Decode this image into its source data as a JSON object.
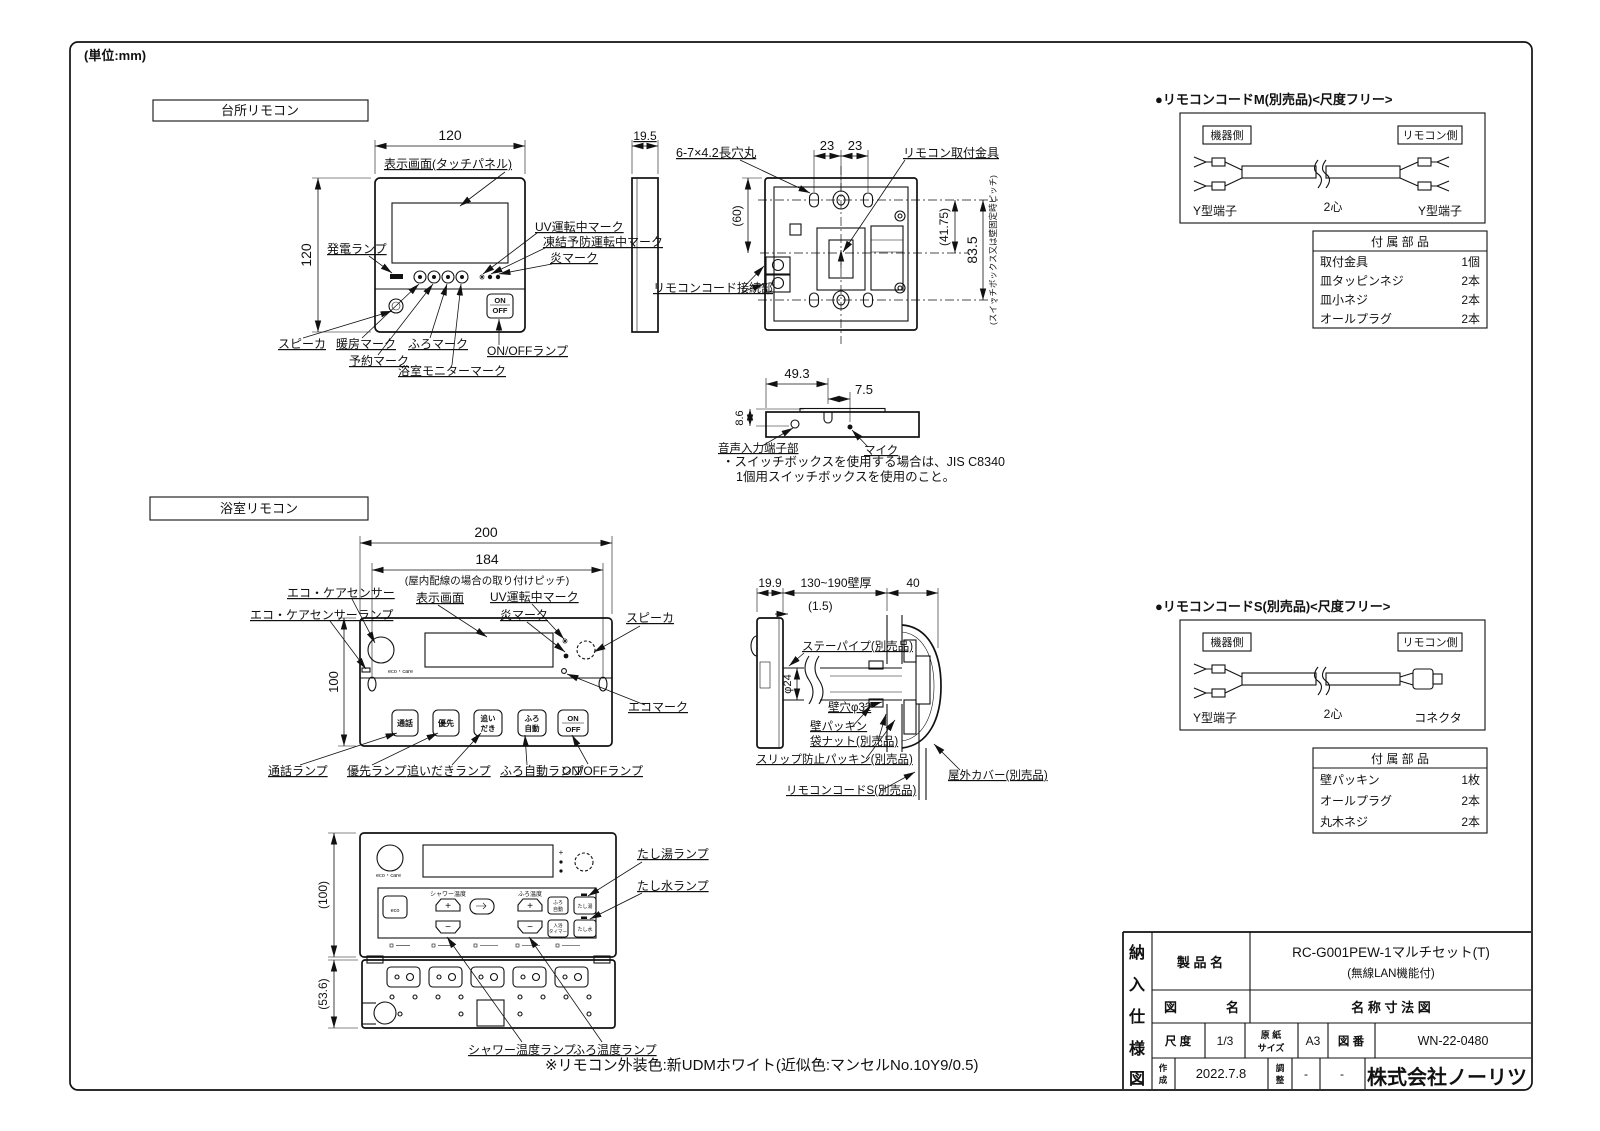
{
  "meta": {
    "units": "(単位:mm)",
    "footnote": "※リモコン外装色:新UDMホワイト(近似色:マンセルNo.10Y9/0.5)"
  },
  "kitchen": {
    "title": "台所リモコン",
    "dims": {
      "w": "120",
      "h": "120",
      "d": "19.5",
      "p23a": "23",
      "p23b": "23",
      "h60": "(60)",
      "h4175": "(41.75)",
      "h835": "83.5",
      "mic_w": "49.3",
      "mic_p": "7.5",
      "mic_h": "8.6"
    },
    "labels": {
      "display": "表示画面(タッチパネル)",
      "power": "発電ランプ",
      "speaker": "スピーカ",
      "heat": "暖房マーク",
      "reserve": "予約マーク",
      "furo": "ふろマーク",
      "monitor": "浴室モニターマーク",
      "uv": "UV運転中マーク",
      "freeze": "凍結予防運転中マーク",
      "flame": "炎マーク",
      "onoff": "ON/OFFランプ",
      "slot": "6-7×4.2長穴丸",
      "bracket": "リモコン取付金具",
      "pitch": "(スイッチボックス又は壁固定時ピッチ)",
      "cord": "リモコンコード接続部",
      "audio": "音声入力端子部",
      "mic": "マイク"
    },
    "btn": {
      "on": "ON",
      "off": "OFF"
    },
    "notes": [
      "・スイッチボックスを使用する場合は、JIS C8340",
      "1個用スイッチボックスを使用のこと。"
    ]
  },
  "bath": {
    "title": "浴室リモコン",
    "dims": {
      "w": "200",
      "p": "184",
      "pitch_note": "(屋内配線の場合の取り付けピッチ)",
      "h": "100",
      "h2": "(100)",
      "h3": "(53.6)",
      "d": "19.9",
      "wall": "130~190壁厚",
      "t": "(1.5)",
      "c": "40",
      "pipe": "φ24",
      "hole": "壁穴φ32"
    },
    "labels": {
      "eco_sensor": "エコ・ケアセンサー",
      "eco_lamp": "エコ・ケアセンサーランプ",
      "display": "表示画面",
      "uv": "UV運転中マーク",
      "flame": "炎マーク",
      "speaker": "スピーカ",
      "eco_mark": "エコマーク",
      "talk_lamp": "通話ランプ",
      "pri_lamp": "優先ランプ",
      "reheat_lamp": "追いだきランプ",
      "auto_lamp": "ふろ自動ランプ",
      "onoff_lamp": "ON/OFFランプ",
      "stay_pipe": "ステーパイプ(別売品)",
      "wall_packing": "壁パッキン",
      "nut": "袋ナット(別売品)",
      "slip": "スリップ防止パッキン(別売品)",
      "cord_s": "リモコンコードS(別売品)",
      "cover": "屋外カバー(別売品)",
      "hotadd_lamp": "たし湯ランプ",
      "wateradd_lamp": "たし水ランプ",
      "shower_lamp": "シャワー温度ランプ",
      "furo_lamp": "ふろ温度ランプ"
    },
    "btns": {
      "talk": "通話",
      "pri": "優先",
      "reheat1": "追い",
      "reheat2": "だき",
      "auto1": "ふろ",
      "auto2": "自動",
      "on": "ON",
      "off": "OFF",
      "eco": "eco",
      "ecocare": "eco・care",
      "shower": "シャワー温度",
      "furo": "ふろ温度",
      "plus": "+",
      "minus": "−",
      "timer1": "入浴",
      "timer2": "タイマー",
      "hot": "たし湯",
      "water": "たし水"
    }
  },
  "cord_m": {
    "title": "●リモコンコードM(別売品)<尺度フリー>",
    "device": "機器側",
    "remote": "リモコン側",
    "t_left": "Y型端子",
    "core": "2心",
    "t_right": "Y型端子",
    "table": {
      "header": "付  属  部  品",
      "rows": [
        {
          "n": "取付金具",
          "q": "1個"
        },
        {
          "n": "皿タッピンネジ",
          "q": "2本"
        },
        {
          "n": "皿小ネジ",
          "q": "2本"
        },
        {
          "n": "オールプラグ",
          "q": "2本"
        }
      ]
    }
  },
  "cord_s": {
    "title": "●リモコンコードS(別売品)<尺度フリー>",
    "device": "機器側",
    "remote": "リモコン側",
    "t_left": "Y型端子",
    "core": "2心",
    "t_right": "コネクタ",
    "table": {
      "header": "付  属  部  品",
      "rows": [
        {
          "n": "壁パッキン",
          "q": "1枚"
        },
        {
          "n": "オールプラグ",
          "q": "2本"
        },
        {
          "n": "丸木ネジ",
          "q": "2本"
        }
      ]
    }
  },
  "title_block": {
    "v": [
      "納",
      "入",
      "仕",
      "様",
      "図"
    ],
    "product_label": "製 品 名",
    "product": "RC-G001PEW-1マルチセット(T)",
    "product_note": "(無線LAN機能付)",
    "fig_l": "図",
    "fig_r": "名",
    "fig_name": "名 称 寸 法 図",
    "scale_label": "尺 度",
    "scale": "1/3",
    "paper_l1": "原 紙",
    "paper_l2": "サイズ",
    "paper": "A3",
    "no_label": "図 番",
    "no": "WN-22-0480",
    "made_l1": "作",
    "made_l2": "成",
    "made": "2022.7.8",
    "adj_l1": "調",
    "adj_l2": "整",
    "adj": "-",
    "blank": "-",
    "company": "株式会社ノーリツ"
  }
}
